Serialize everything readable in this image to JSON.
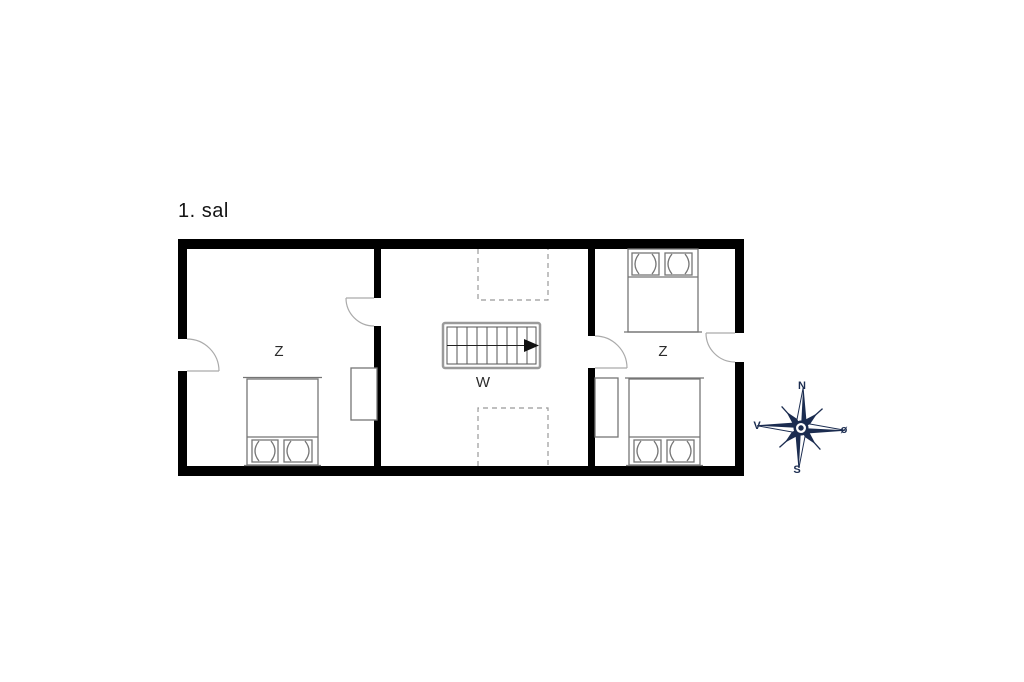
{
  "title": "1. sal",
  "floor_plan": {
    "rooms": [
      {
        "name": "bedroom-west",
        "label": "Z"
      },
      {
        "name": "hallway-stairs",
        "label": "W"
      },
      {
        "name": "bedroom-east",
        "label": "Z"
      }
    ],
    "stairs": {
      "treads": 9,
      "direction": "arrow-east"
    },
    "bed_count": 3,
    "wardrobe_count": 2,
    "door_count": 4
  },
  "compass": {
    "north": "N",
    "south": "S",
    "west": "V",
    "east": "ø"
  },
  "colors": {
    "wall": "#000000",
    "furniture": "#757575",
    "stair_border": "#9a9a9a",
    "dashed_line": "#999999",
    "door_arc": "#aaaaaa",
    "label": "#2b2b2b",
    "compass": "#1b2c50",
    "background": "#ffffff"
  }
}
